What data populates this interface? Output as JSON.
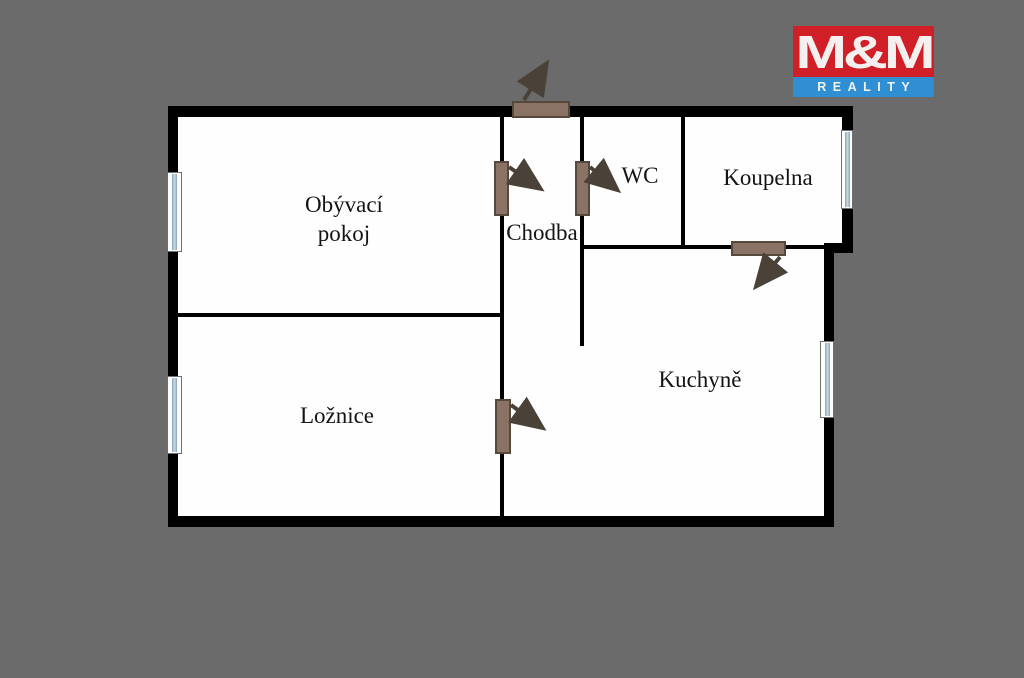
{
  "title": "Floor plan 2+1 apartment",
  "rooms": {
    "obyvaci": {
      "line1": "Obývací",
      "line2": "pokoj"
    },
    "chodba": {
      "label": "Chodba"
    },
    "wc": {
      "label": "WC"
    },
    "koupelna": {
      "label": "Koupelna"
    },
    "loznice": {
      "label": "Ložnice"
    },
    "kuchyne": {
      "label": "Kuchyně"
    }
  },
  "logo": {
    "brand": "M&M",
    "tagline": "REALITY"
  },
  "features": {
    "windows": [
      {
        "room": "Obývací pokoj",
        "wall": "left"
      },
      {
        "room": "Ložnice",
        "wall": "left"
      },
      {
        "room": "Koupelna",
        "wall": "right"
      },
      {
        "room": "Kuchyně",
        "wall": "right"
      }
    ],
    "doors": [
      {
        "id": "entrance",
        "on": "top wall, opens outward"
      },
      {
        "id": "obyvaci-door",
        "on": "hallway left wall, opens into hallway"
      },
      {
        "id": "wc-door",
        "on": "hallway right wall, opens into WC"
      },
      {
        "id": "loznice-door",
        "on": "bedroom right wall, opens into kitchen area"
      },
      {
        "id": "koupelna-door",
        "on": "bathroom bottom wall, opens into kitchen"
      }
    ]
  },
  "colors": {
    "background": "#6b6b6b",
    "wall": "#000000",
    "floor": "#fefefe",
    "door_fill": "#8a7364",
    "door_border": "#55493b",
    "door_arrow": "#4a4238",
    "window_glass": "#a9c2d2",
    "label_text": "#141414",
    "logo_red": "#d01f26",
    "logo_blue": "#2f8fd2",
    "logo_text": "#f3f0ef"
  }
}
